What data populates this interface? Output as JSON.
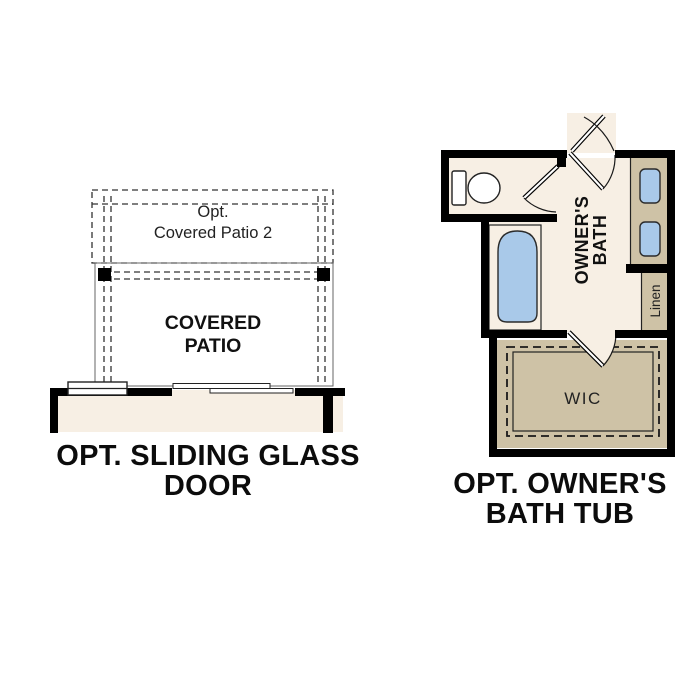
{
  "colors": {
    "wall_black": "#000000",
    "floor_cream": "#f7efe4",
    "patio_gray": "#e3e3e3",
    "patio2_gray": "#e8e8e8",
    "cabinet_tan": "#cec2a6",
    "fixture_blue": "#a9c9e9"
  },
  "left_plan": {
    "caption": "OPT. SLIDING GLASS DOOR",
    "patio2_label_line1": "Opt.",
    "patio2_label_line2": "Covered Patio 2",
    "patio_label_line1": "COVERED",
    "patio_label_line2": "PATIO"
  },
  "right_plan": {
    "caption_line1": "OPT. OWNER'S",
    "caption_line2": "BATH TUB",
    "bath_label_line1": "OWNER'S",
    "bath_label_line2": "BATH",
    "linen_label": "Linen",
    "wic_label": "WIC"
  }
}
